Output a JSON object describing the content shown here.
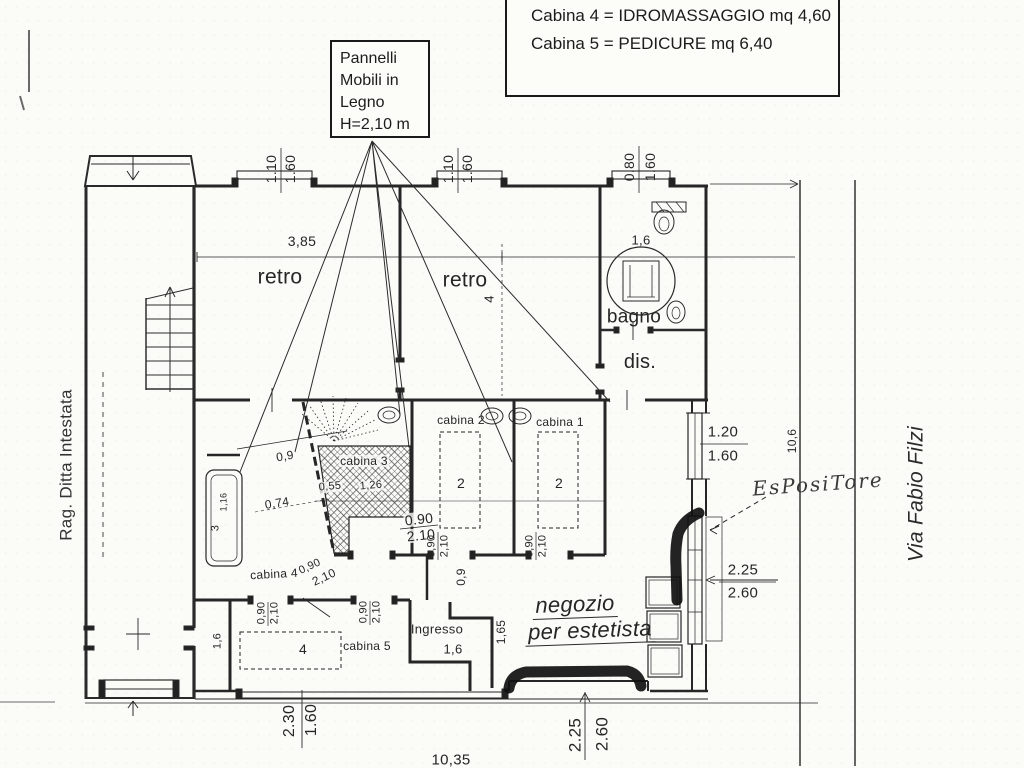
{
  "legend": {
    "lines": [
      "Cabina 4 = IDROMASSAGGIO mq 4,60",
      "Cabina 5 = PEDICURE mq 6,40"
    ]
  },
  "panels_note": {
    "lines": [
      "Pannelli",
      "Mobili in",
      "Legno",
      "H=2,10 m"
    ]
  },
  "rooms": {
    "retro_left": "retro",
    "retro_right": "retro",
    "bagno": "bagno",
    "dis": "dis.",
    "cabina1": "cabina 1",
    "cabina2": "cabina 2",
    "cabina3": "cabina 3",
    "cabina4": "cabina 4",
    "cabina5": "cabina 5",
    "ingresso": "Ingresso",
    "negozio_line1": "negozio",
    "negozio_line2": "per estetista"
  },
  "annotations": {
    "owner": "Rag. Ditta Intestata",
    "street": "Via Fabio Filzi",
    "handwritten": "EsPosiTore"
  },
  "dims": {
    "w110": "1.10",
    "w160": "1.60",
    "w080": "0.80",
    "retro_w": "3,85",
    "retro_d": "4",
    "one6": "1,6",
    "pass09": "0,9",
    "c4_diag": "0,74",
    "c4_a": "1,16",
    "c4_b": "3",
    "c3_a": "0,55",
    "c3_b": "1,26",
    "bed_two": "2",
    "bed_four": "4",
    "door_w_dot": "0.90",
    "door_h_dot": "2.10",
    "door_w": "0,90",
    "door_h": "2,10",
    "pass165": "1,65",
    "rwin_a": "1.20",
    "rwin_b": "1.60",
    "depth": "10,6",
    "front_a": "2.25",
    "front_b": "2.60",
    "bl_a": "2.30",
    "bl_b": "1.60",
    "total": "10,35"
  }
}
